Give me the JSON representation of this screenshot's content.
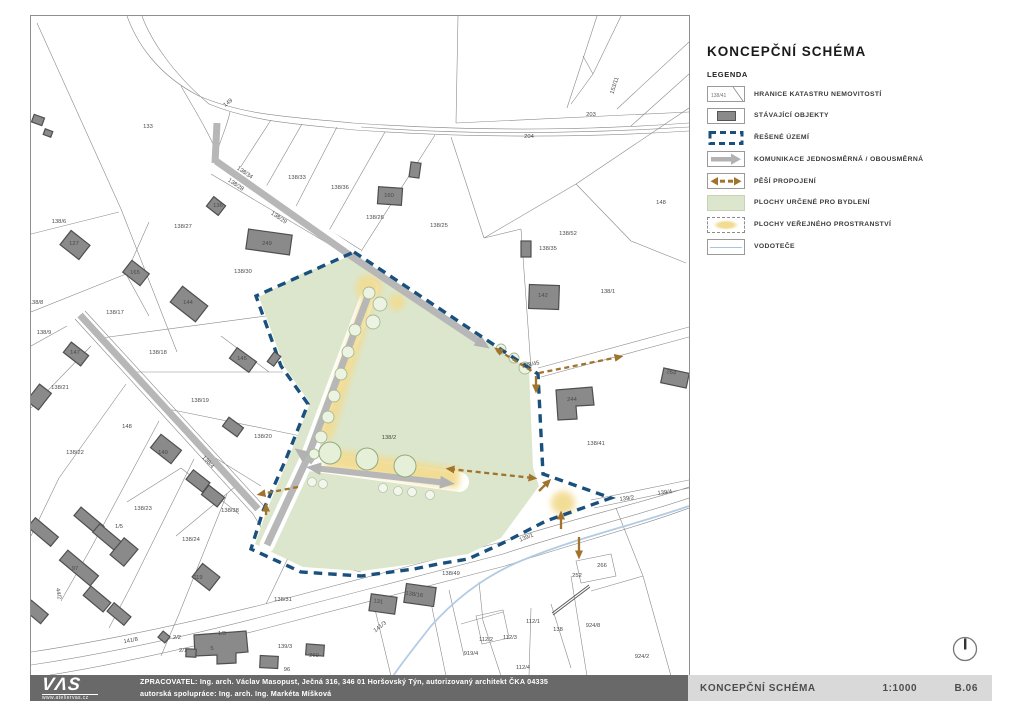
{
  "page_title": "KONCEPČNÍ SCHÉMA",
  "legend": {
    "heading": "LEGENDA",
    "parcel_symbol_text": "138/41",
    "items": [
      "HRANICE KATASTRU NEMOVITOSTÍ",
      "STÁVAJÍCÍ OBJEKTY",
      "ŘEŠENÉ ÚZEMÍ",
      "KOMUNIKACE JEDNOSMĚRNÁ / OBOUSMĚRNÁ",
      "PĚŠÍ PROPOJENÍ",
      "PLOCHY URČENÉ PRO BYDLENÍ",
      "PLOCHY VEŘEJNÉHO PROSTRANSTVÍ",
      "VODOTEČE"
    ]
  },
  "footer": {
    "logo_text": "VΛS",
    "logo_sub": "www.ateliervas.cz",
    "line1": "ZPRACOVATEL: Ing. arch.  Václav Masopust, Ječná 316, 346 01 Horšovský Týn, autorizovaný architekt ČKA 04335",
    "line2": "autorská spolupráce: Ing. arch. Ing. Markéta Míšková",
    "sheet_title": "KONCEPČNÍ SCHÉMA",
    "scale": "1:1000",
    "sheet_number": "B.06"
  },
  "colors": {
    "boundary_blue": "#1a507d",
    "residential_green": "#dbe6cc",
    "public_space_yellow": "#f2dc92",
    "pedestrian_brown": "#a1742e",
    "road_gray": "#b7b7b7",
    "building_gray": "#8a8a8a",
    "stream_blue": "#b3cbe4",
    "footer_dark": "#696969",
    "footer_light": "#d9d9d9"
  },
  "map": {
    "labels": [
      {
        "t": "133",
        "x": 117,
        "y": 112
      },
      {
        "t": "149",
        "x": 198,
        "y": 88,
        "r": -38
      },
      {
        "t": "153/11",
        "x": 585,
        "y": 70,
        "r": -72
      },
      {
        "t": "203",
        "x": 560,
        "y": 100
      },
      {
        "t": "204",
        "x": 498,
        "y": 122
      },
      {
        "t": "148",
        "x": 630,
        "y": 188
      },
      {
        "t": "138/33",
        "x": 266,
        "y": 163
      },
      {
        "t": "138/36",
        "x": 309,
        "y": 173
      },
      {
        "t": "138/26",
        "x": 344,
        "y": 203
      },
      {
        "t": "138/25",
        "x": 408,
        "y": 211
      },
      {
        "t": "138/27",
        "x": 152,
        "y": 212
      },
      {
        "t": "138/6",
        "x": 28,
        "y": 207
      },
      {
        "t": "136",
        "x": 187,
        "y": 191
      },
      {
        "t": "138/34",
        "x": 213,
        "y": 158,
        "r": 34
      },
      {
        "t": "138/28",
        "x": 204,
        "y": 170,
        "r": 34
      },
      {
        "t": "138/29",
        "x": 247,
        "y": 203,
        "r": 34
      },
      {
        "t": "138/30",
        "x": 212,
        "y": 257
      },
      {
        "t": "249",
        "x": 236,
        "y": 229
      },
      {
        "t": "127",
        "x": 43,
        "y": 229
      },
      {
        "t": "165",
        "x": 104,
        "y": 258
      },
      {
        "t": "144",
        "x": 157,
        "y": 288
      },
      {
        "t": "138/17",
        "x": 84,
        "y": 298
      },
      {
        "t": "138/8",
        "x": 5,
        "y": 288
      },
      {
        "t": "138/9",
        "x": 13,
        "y": 318
      },
      {
        "t": "147",
        "x": 44,
        "y": 338
      },
      {
        "t": "138/18",
        "x": 127,
        "y": 338
      },
      {
        "t": "145",
        "x": 211,
        "y": 344
      },
      {
        "t": "138/21",
        "x": 29,
        "y": 373
      },
      {
        "t": "138/19",
        "x": 169,
        "y": 386
      },
      {
        "t": "148",
        "x": 96,
        "y": 412
      },
      {
        "t": "138/20",
        "x": 232,
        "y": 422
      },
      {
        "t": "138/22",
        "x": 44,
        "y": 438
      },
      {
        "t": "149",
        "x": 132,
        "y": 438
      },
      {
        "t": "138/2",
        "x": 358,
        "y": 423
      },
      {
        "t": "160",
        "x": 358,
        "y": 181
      },
      {
        "t": "138/52",
        "x": 537,
        "y": 219
      },
      {
        "t": "138/35",
        "x": 517,
        "y": 234
      },
      {
        "t": "142",
        "x": 512,
        "y": 281
      },
      {
        "t": "138/1",
        "x": 577,
        "y": 277
      },
      {
        "t": "138/45",
        "x": 500,
        "y": 350,
        "r": -11
      },
      {
        "t": "244",
        "x": 541,
        "y": 385
      },
      {
        "t": "138/41",
        "x": 565,
        "y": 429
      },
      {
        "t": "264",
        "x": 640,
        "y": 358,
        "r": 10
      },
      {
        "t": "139/2",
        "x": 596,
        "y": 484,
        "r": -7
      },
      {
        "t": "139/4",
        "x": 634,
        "y": 478,
        "r": -7
      },
      {
        "t": "139/1",
        "x": 496,
        "y": 523,
        "r": -22
      },
      {
        "t": "138/4",
        "x": 176,
        "y": 447,
        "r": 47
      },
      {
        "t": "138/49",
        "x": 420,
        "y": 559
      },
      {
        "t": "138/16",
        "x": 383,
        "y": 580,
        "r": 8
      },
      {
        "t": "131",
        "x": 347,
        "y": 587,
        "r": 8
      },
      {
        "t": "141/3",
        "x": 350,
        "y": 612,
        "r": -38
      },
      {
        "t": "138/31",
        "x": 252,
        "y": 585
      },
      {
        "t": "138/23",
        "x": 112,
        "y": 494
      },
      {
        "t": "138/24",
        "x": 160,
        "y": 525
      },
      {
        "t": "138/38",
        "x": 199,
        "y": 496
      },
      {
        "t": "1/5",
        "x": 88,
        "y": 512
      },
      {
        "t": "97",
        "x": 44,
        "y": 554
      },
      {
        "t": "119",
        "x": 167,
        "y": 563
      },
      {
        "t": "44/2",
        "x": 26,
        "y": 578,
        "r": 80
      },
      {
        "t": "141/8",
        "x": 100,
        "y": 626,
        "r": -10
      },
      {
        "t": "139/3",
        "x": 254,
        "y": 632
      },
      {
        "t": "269",
        "x": 283,
        "y": 641
      },
      {
        "t": "96",
        "x": 256,
        "y": 655
      },
      {
        "t": "1/3",
        "x": 191,
        "y": 619
      },
      {
        "t": "2/2",
        "x": 146,
        "y": 623
      },
      {
        "t": "2/1",
        "x": 152,
        "y": 636
      },
      {
        "t": "5",
        "x": 181,
        "y": 634
      },
      {
        "t": "112/1",
        "x": 502,
        "y": 607
      },
      {
        "t": "112/2",
        "x": 455,
        "y": 625
      },
      {
        "t": "112/3",
        "x": 479,
        "y": 623
      },
      {
        "t": "112/4",
        "x": 492,
        "y": 653
      },
      {
        "t": "919/4",
        "x": 440,
        "y": 639
      },
      {
        "t": "138",
        "x": 527,
        "y": 615
      },
      {
        "t": "924/8",
        "x": 562,
        "y": 611
      },
      {
        "t": "924/2",
        "x": 611,
        "y": 642
      },
      {
        "t": "252",
        "x": 546,
        "y": 561
      },
      {
        "t": "266",
        "x": 571,
        "y": 551
      }
    ]
  }
}
